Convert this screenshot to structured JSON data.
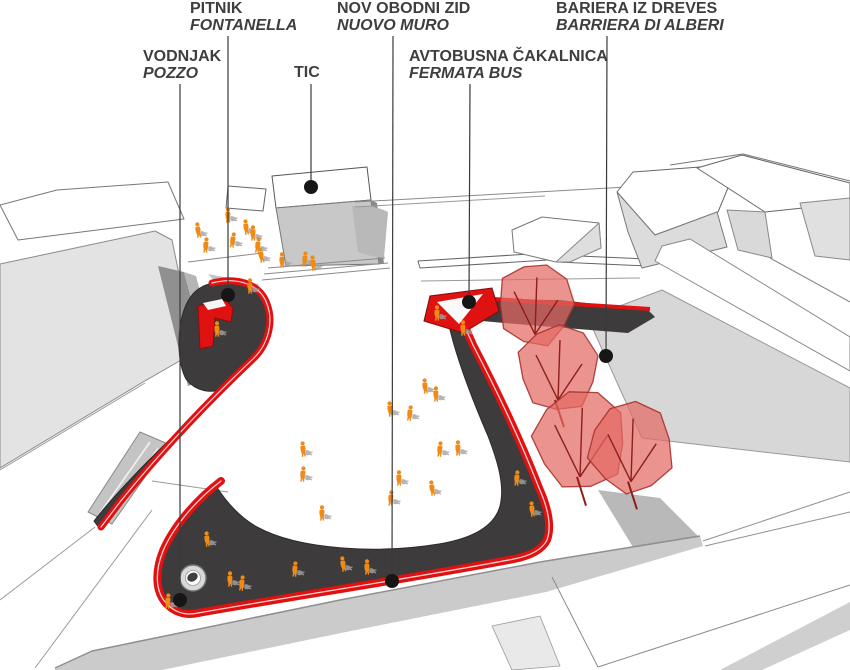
{
  "drawing_title": "site plan diagram",
  "colors": {
    "accent_red": "#df1111",
    "dark_red_edge": "#8c0d0d",
    "charcoal": "#3d3b3c",
    "people_orange": "#ef8a17",
    "shadow_gray": "#a3a3a3",
    "tree_fill": "#e36a64",
    "tree_stroke": "#a8322e",
    "branch_red": "#8d1e1a",
    "label_text": "#3e3e3e",
    "leader_line": "#3a3a3a",
    "dot_black": "#161616",
    "building_light": "#e3e3e3",
    "road_gray": "#cbcbcb"
  },
  "annotations": [
    {
      "id": "pitnik",
      "line1": "PITNIK",
      "line2": "FONTANELLA",
      "label_x": 190,
      "label_y": 1,
      "line_x": 228,
      "line_y1": 36,
      "dot_x": 228,
      "dot_y": 295
    },
    {
      "id": "vodnjak",
      "line1": "VODNJAK",
      "line2": "POZZO",
      "label_x": 143,
      "label_y": 49,
      "line_x": 180,
      "line_y1": 84,
      "dot_x": 180,
      "dot_y": 600
    },
    {
      "id": "tic",
      "line1": "TIC",
      "line2": "",
      "label_x": 294,
      "label_y": 65,
      "line_x": 311,
      "line_y1": 84,
      "dot_x": 311,
      "dot_y": 187
    },
    {
      "id": "nov-obodni-zid",
      "line1": "NOV OBODNI ZID",
      "line2": "NUOVO MURO",
      "label_x": 337,
      "label_y": 1,
      "line_x": 393,
      "line_y1": 36,
      "dot_x": 392,
      "dot_y": 581
    },
    {
      "id": "avtobusna-cakalnica",
      "line1": "AVTOBUSNA ČAKALNICA",
      "line2": "FERMATA BUS",
      "label_x": 409,
      "label_y": 49,
      "line_x": 470,
      "line_y1": 84,
      "dot_x": 469,
      "dot_y": 302
    },
    {
      "id": "bariera-iz-dreves",
      "line1": "BARIERA IZ DREVES",
      "line2": "BARRIERA DI ALBERI",
      "label_x": 556,
      "label_y": 1,
      "line_x": 607,
      "line_y1": 36,
      "dot_x": 606,
      "dot_y": 356
    }
  ],
  "trees": [
    {
      "cx": 535,
      "cy": 304,
      "r": 38
    },
    {
      "cx": 558,
      "cy": 368,
      "r": 40
    },
    {
      "cx": 580,
      "cy": 440,
      "r": 46
    },
    {
      "cx": 631,
      "cy": 448,
      "r": 42
    }
  ],
  "well": {
    "cx": 193,
    "cy": 578
  },
  "people": [
    [
      198,
      229,
      -8
    ],
    [
      206,
      244,
      6
    ],
    [
      228,
      214,
      0
    ],
    [
      233,
      239,
      10
    ],
    [
      246,
      226,
      -6
    ],
    [
      253,
      232,
      0
    ],
    [
      258,
      244,
      8
    ],
    [
      261,
      254,
      -10
    ],
    [
      282,
      259,
      0
    ],
    [
      305,
      258,
      6
    ],
    [
      313,
      262,
      -6
    ],
    [
      250,
      285,
      0
    ],
    [
      217,
      328,
      0
    ],
    [
      303,
      448,
      -5
    ],
    [
      303,
      473,
      6
    ],
    [
      322,
      512,
      0
    ],
    [
      343,
      563,
      -8
    ],
    [
      295,
      568,
      5
    ],
    [
      230,
      578,
      0
    ],
    [
      242,
      582,
      8
    ],
    [
      390,
      408,
      -6
    ],
    [
      391,
      497,
      5
    ],
    [
      399,
      477,
      0
    ],
    [
      410,
      412,
      8
    ],
    [
      425,
      385,
      -5
    ],
    [
      436,
      393,
      0
    ],
    [
      440,
      448,
      6
    ],
    [
      432,
      487,
      -8
    ],
    [
      458,
      447,
      0
    ],
    [
      517,
      477,
      5
    ],
    [
      532,
      508,
      -6
    ],
    [
      463,
      327,
      0
    ],
    [
      168,
      600,
      5
    ],
    [
      207,
      538,
      -5
    ],
    [
      437,
      312,
      0
    ],
    [
      367,
      566,
      0
    ]
  ]
}
